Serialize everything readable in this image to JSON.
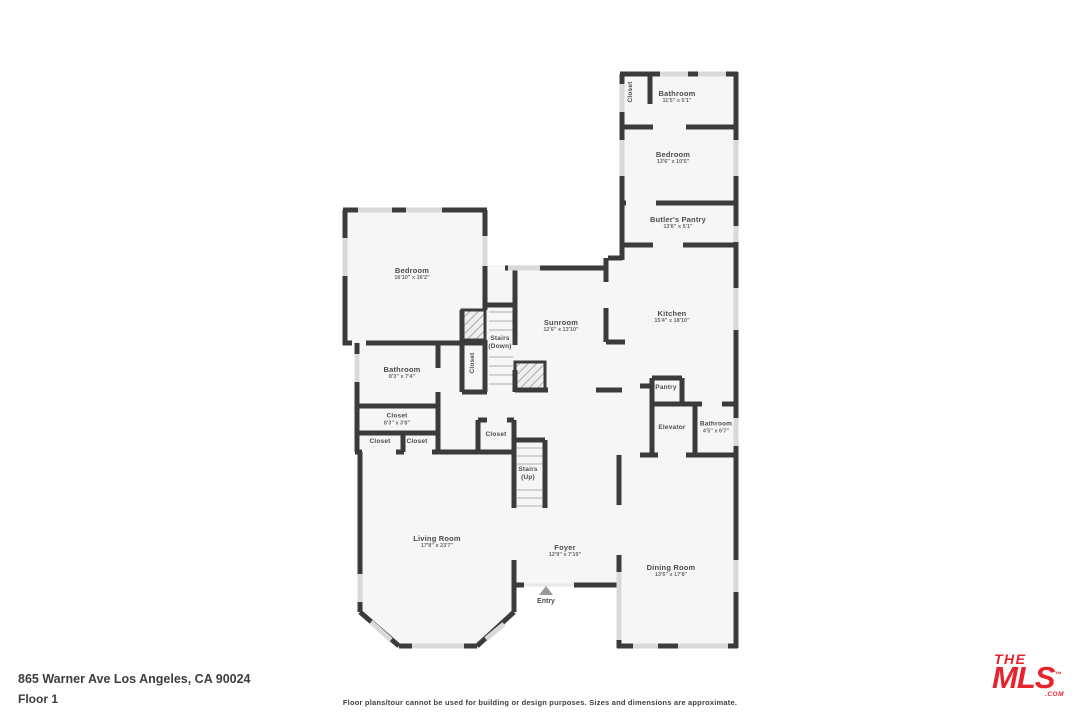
{
  "rooms": [
    {
      "id": "closet-top",
      "name": "Closet",
      "dims": ""
    },
    {
      "id": "bathroom-top",
      "name": "Bathroom",
      "dims": "11'5\" x 5'1\""
    },
    {
      "id": "bedroom-right",
      "name": "Bedroom",
      "dims": "13'6\" x 10'5\""
    },
    {
      "id": "butlers-pantry",
      "name": "Butler's Pantry",
      "dims": "13'6\" x 5'1\""
    },
    {
      "id": "kitchen",
      "name": "Kitchen",
      "dims": "15'4\" x 18'10\""
    },
    {
      "id": "sunroom",
      "name": "Sunroom",
      "dims": "12'6\" x 13'10\""
    },
    {
      "id": "bedroom-left",
      "name": "Bedroom",
      "dims": "16'10\" x 16'2\""
    },
    {
      "id": "stairs-down",
      "name": "Stairs",
      "dims": "(Down)"
    },
    {
      "id": "closet-hall",
      "name": "Closet",
      "dims": ""
    },
    {
      "id": "bathroom-left",
      "name": "Bathroom",
      "dims": "8'3\" x 7'4\""
    },
    {
      "id": "closet-main",
      "name": "Closet",
      "dims": "8'3\" x 3'8\""
    },
    {
      "id": "closet-small-1",
      "name": "Closet",
      "dims": ""
    },
    {
      "id": "closet-small-2",
      "name": "Closet",
      "dims": ""
    },
    {
      "id": "closet-mid",
      "name": "Closet",
      "dims": ""
    },
    {
      "id": "stairs-up",
      "name": "Stairs",
      "dims": "(Up)"
    },
    {
      "id": "pantry",
      "name": "Pantry",
      "dims": ""
    },
    {
      "id": "elevator",
      "name": "Elevator",
      "dims": ""
    },
    {
      "id": "bathroom-small",
      "name": "Bathroom",
      "dims": "4'5\" x 6'7\""
    },
    {
      "id": "living-room",
      "name": "Living Room",
      "dims": "17'8\" x 23'7\""
    },
    {
      "id": "foyer",
      "name": "Foyer",
      "dims": "12'9\" x 7'10\""
    },
    {
      "id": "dining-room",
      "name": "Dining Room",
      "dims": "13'6\" x 17'8\""
    }
  ],
  "entry": {
    "label": "Entry"
  },
  "footer": {
    "address": "865 Warner Ave Los Angeles, CA 90024",
    "floor": "Floor 1",
    "disclaimer": "Floor plans/tour cannot be used for building or design purposes. Sizes and dimensions are approximate."
  },
  "logo": {
    "the": "THE",
    "mls": "MLS",
    "tm": "™",
    "com": ".COM",
    "color": "#e8232e"
  },
  "colors": {
    "wall": "#3b3b3b",
    "floor": "#f6f6f6",
    "window": "#d9d9d9",
    "accent_red": "#e8232e"
  }
}
